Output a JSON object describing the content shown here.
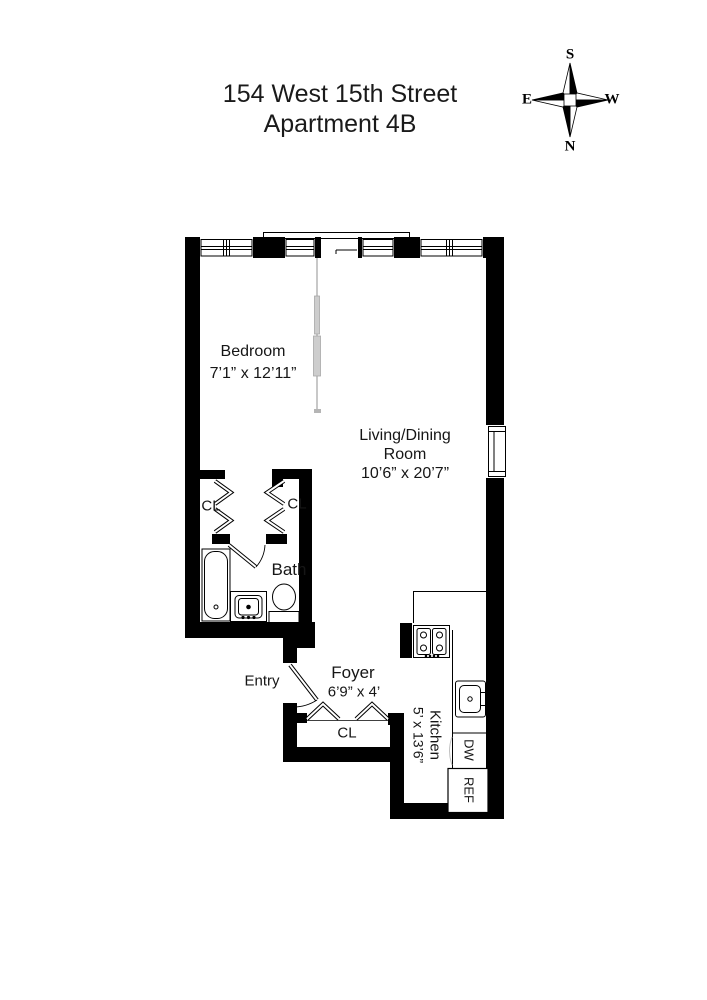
{
  "title": {
    "line1": "154 West 15th Street",
    "line2": "Apartment 4B"
  },
  "compass": {
    "top": "S",
    "bottom": "N",
    "left": "E",
    "right": "W"
  },
  "labels": {
    "bedroom_name": "Bedroom",
    "bedroom_dims": "7’1” x 12’11”",
    "living_name_1": "Living/Dining",
    "living_name_2": "Room",
    "living_dims": "10’6” x 20’7”",
    "closet_left": "CL",
    "closet_right": "CL",
    "closet_foyer": "CL",
    "bath": "Bath",
    "entry": "Entry",
    "foyer_name": "Foyer",
    "foyer_dims": "6’9” x 4’",
    "kitchen_name": "Kitchen",
    "kitchen_dims": "5’ x 13’6”",
    "dishwasher": "DW",
    "refrigerator": "REF"
  },
  "colors": {
    "background": "#ffffff",
    "wall": "#000000",
    "line": "#000000",
    "partition": "#bdbdbd",
    "text": "#161616"
  }
}
